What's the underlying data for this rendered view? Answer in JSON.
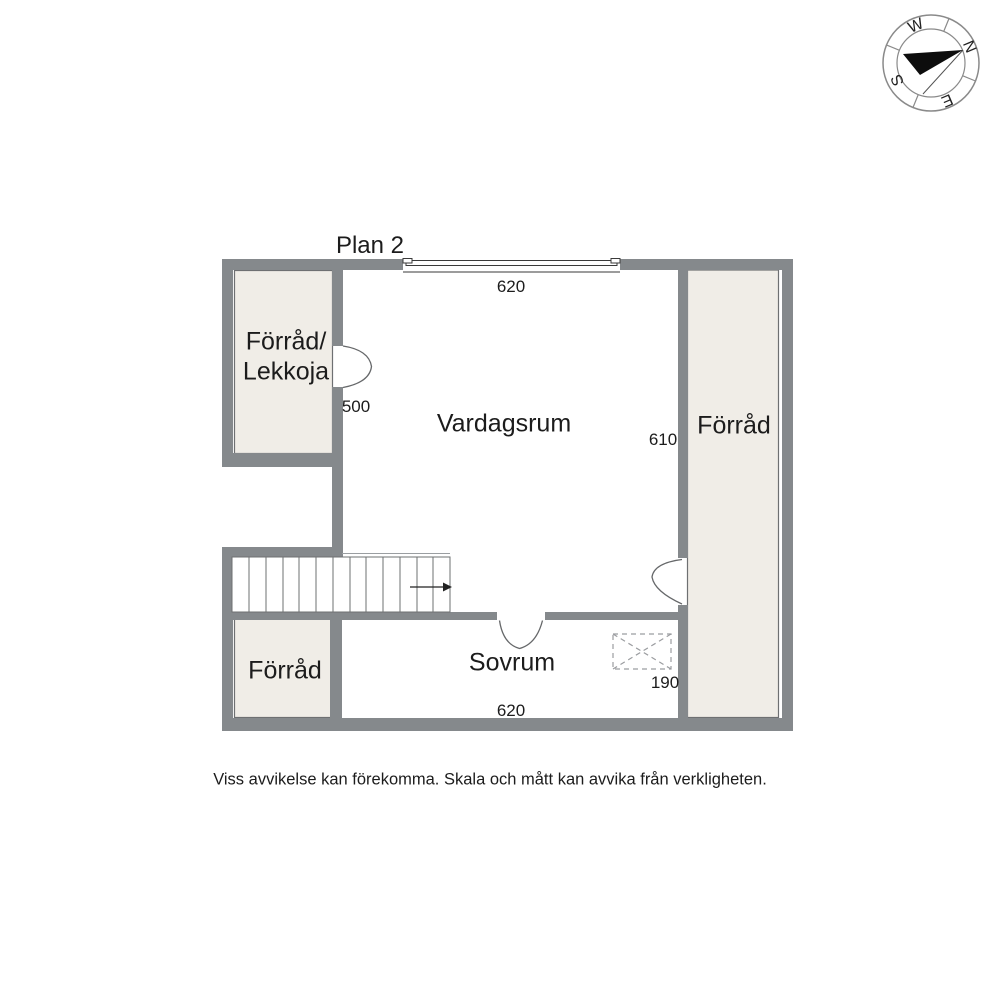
{
  "title": "Plan 2",
  "rooms": {
    "forrad_lekkoja": "Förråd/\nLekkoja",
    "vardagsrum": "Vardagsrum",
    "forrad_right": "Förråd",
    "forrad_bottom": "Förråd",
    "sovrum": "Sovrum"
  },
  "dimensions": {
    "top": "620",
    "left": "500",
    "right": "610",
    "hatch": "190",
    "bottom": "620"
  },
  "compass": {
    "north": "N",
    "east": "E",
    "south": "S",
    "west": "W"
  },
  "disclaimer": "Viss avvikelse kan förekomma. Skala och mått kan avvika från verkligheten.",
  "colors": {
    "wall": "#85898c",
    "room_fill": "#f0ede7",
    "room_outline": "#6e7072",
    "text": "#1c1c1c"
  }
}
